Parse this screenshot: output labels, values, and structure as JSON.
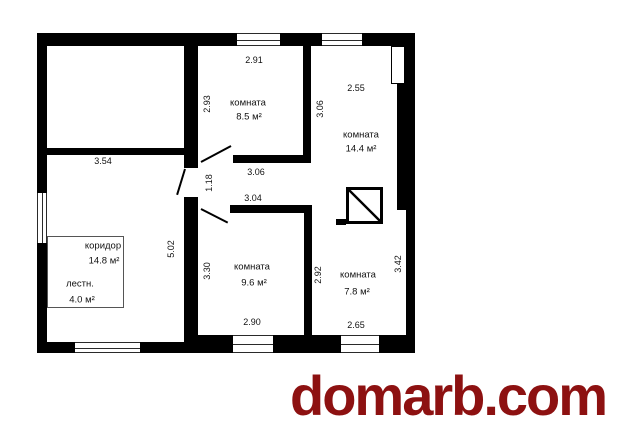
{
  "watermark": {
    "text": "domarb.com",
    "color": "#8d1111"
  },
  "colors": {
    "walls": "#000000",
    "watermark": "#8d1111"
  },
  "plan": {
    "rooms": {
      "room_8_5": {
        "name": "комната",
        "area": "8.5 м²"
      },
      "room_14_4": {
        "name": "комната",
        "area": "14.4 м²"
      },
      "room_9_6": {
        "name": "комната",
        "area": "9.6 м²"
      },
      "room_7_8": {
        "name": "комната",
        "area": "7.8 м²"
      },
      "corridor": {
        "name": "коридор",
        "area": "14.8 м²"
      },
      "stairs": {
        "name": "лестн.",
        "area": "4.0 м²"
      }
    },
    "dimensions": {
      "top_left_room_width": "3.54",
      "room85_width": "2.91",
      "room85_height": "2.93",
      "room144_width": "2.55",
      "room144_height": "3.06",
      "passage_top_width": "3.06",
      "passage_bottom_width": "3.04",
      "door_opening": "1.18",
      "corridor_height": "5.02",
      "room96_height": "3.30",
      "room96_width": "2.90",
      "room78_left_height": "2.92",
      "room78_right_height": "3.42",
      "room78_width": "2.65"
    },
    "symbols": {
      "vent_shaft": "crossed-square"
    }
  }
}
